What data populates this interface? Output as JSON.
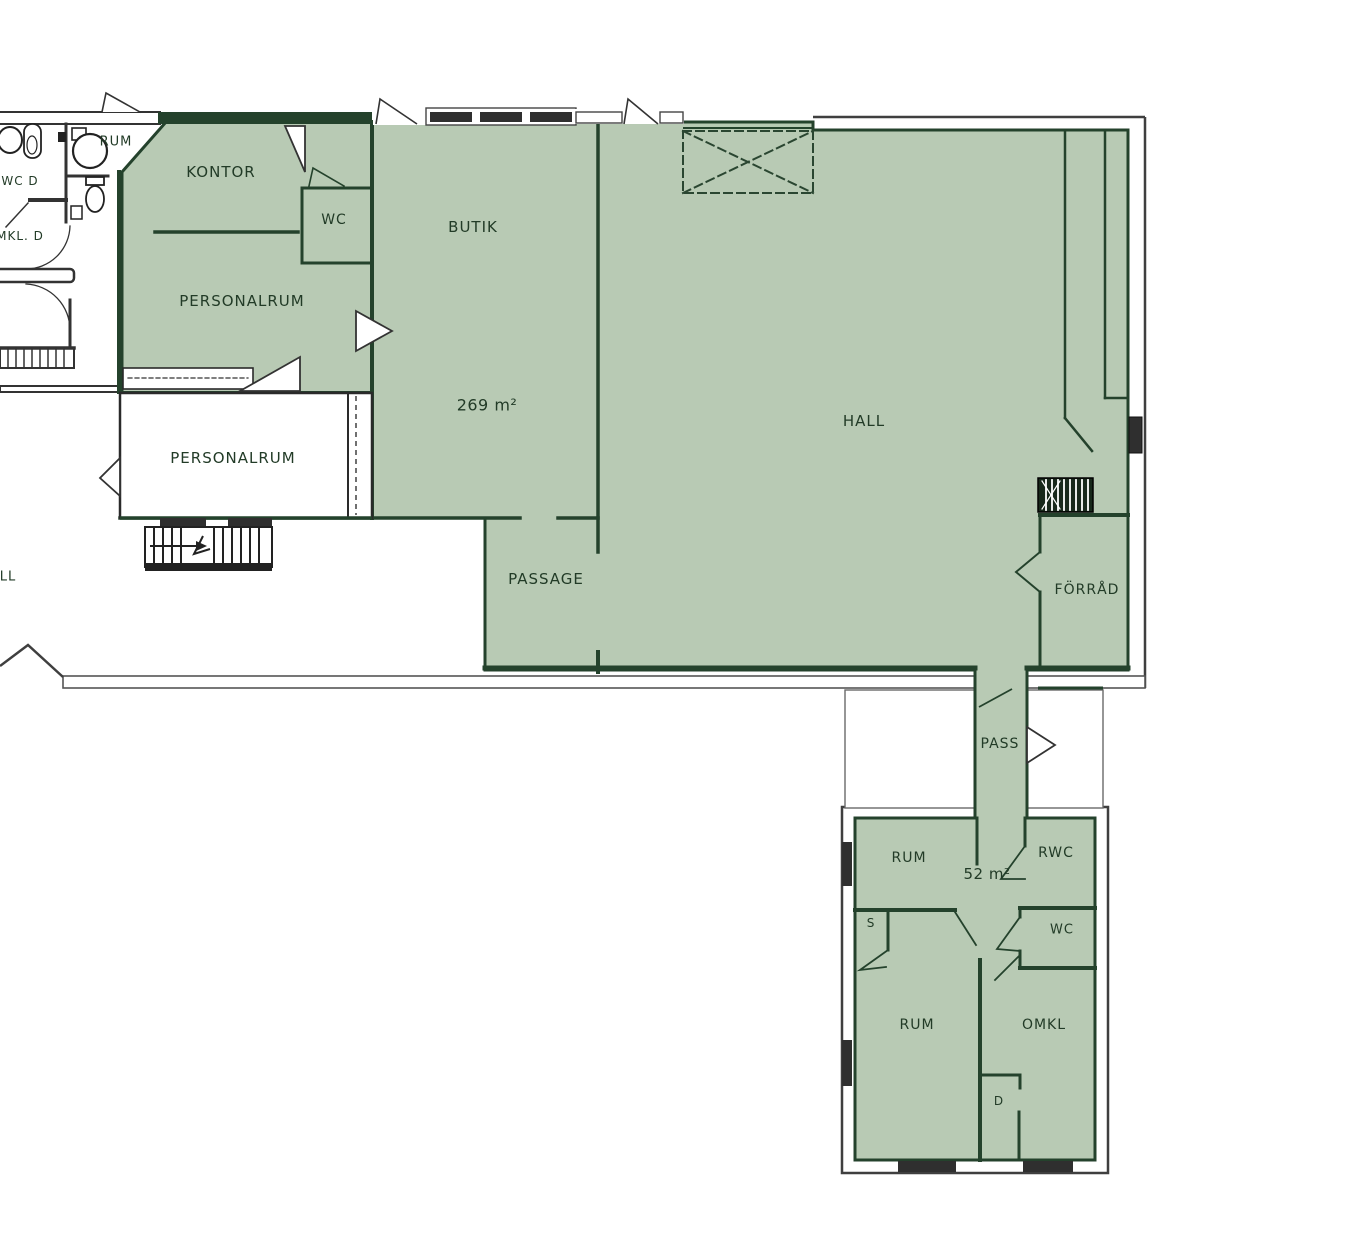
{
  "plan_type": "floor-plan",
  "colors": {
    "area_fill": "#b8cab4",
    "wall_green": "#24422c",
    "outline_gray": "#3f3f3f",
    "window_dark": "#2f2f2f",
    "label_text": "#223b27"
  },
  "main_unit": {
    "area_label": "269 m²",
    "rooms": {
      "kontor": "KONTOR",
      "wc": "WC",
      "personalrum": "PERSONALRUM",
      "butik": "BUTIK",
      "hall": "HALL",
      "passage": "PASSAGE",
      "forrad": "FÖRRÅD",
      "pass": "PASS"
    }
  },
  "annex_unit": {
    "area_label": "52 m²",
    "rooms": {
      "rum_upper": "RUM",
      "rwc": "RWC",
      "wc": "WC",
      "s": "S",
      "rum_lower": "RUM",
      "omkl": "OMKL",
      "d": "D"
    }
  },
  "adjacent_rooms": {
    "rum_nw": "RUM",
    "wc_d": "WC D",
    "omkl_d": "MKL. D",
    "personalrum_white": "PERSONALRUM",
    "hall_fragment": "LL"
  }
}
